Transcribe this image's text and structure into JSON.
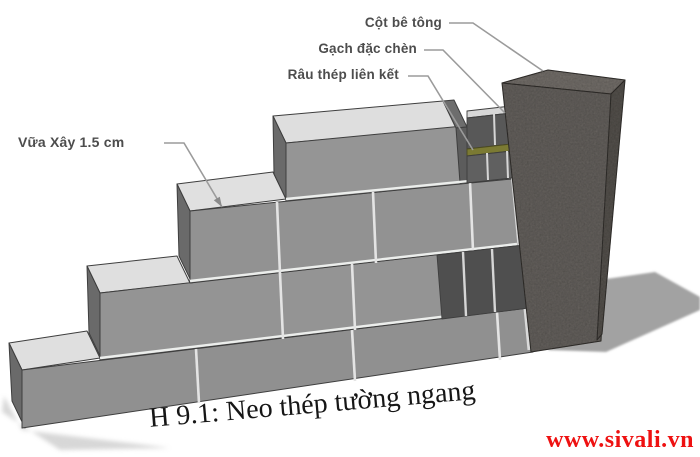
{
  "annotations": {
    "column_label": "Cột bê tông",
    "infill_label": "Gạch đặc chèn",
    "tie_label": "Râu thép liên kết",
    "mortar_label": "Vữa Xây 1.5 cm"
  },
  "caption": "H 9.1: Neo thép tường ngang",
  "watermark": "www.sivali.vn",
  "colors": {
    "label_text": "#4d4d4d",
    "caption_text": "#161616",
    "watermark_red": "#ee1111",
    "wall_face": "#939393",
    "wall_top": "#dfdfdf",
    "wall_end": "#6a6a6a",
    "mortar_joint": "#eceeec",
    "infill_brick": "#555555",
    "steel_tie": "#7b7a33",
    "column_front": "#6b6763",
    "shadow": "#a2a2a2",
    "background": "#ffffff"
  }
}
